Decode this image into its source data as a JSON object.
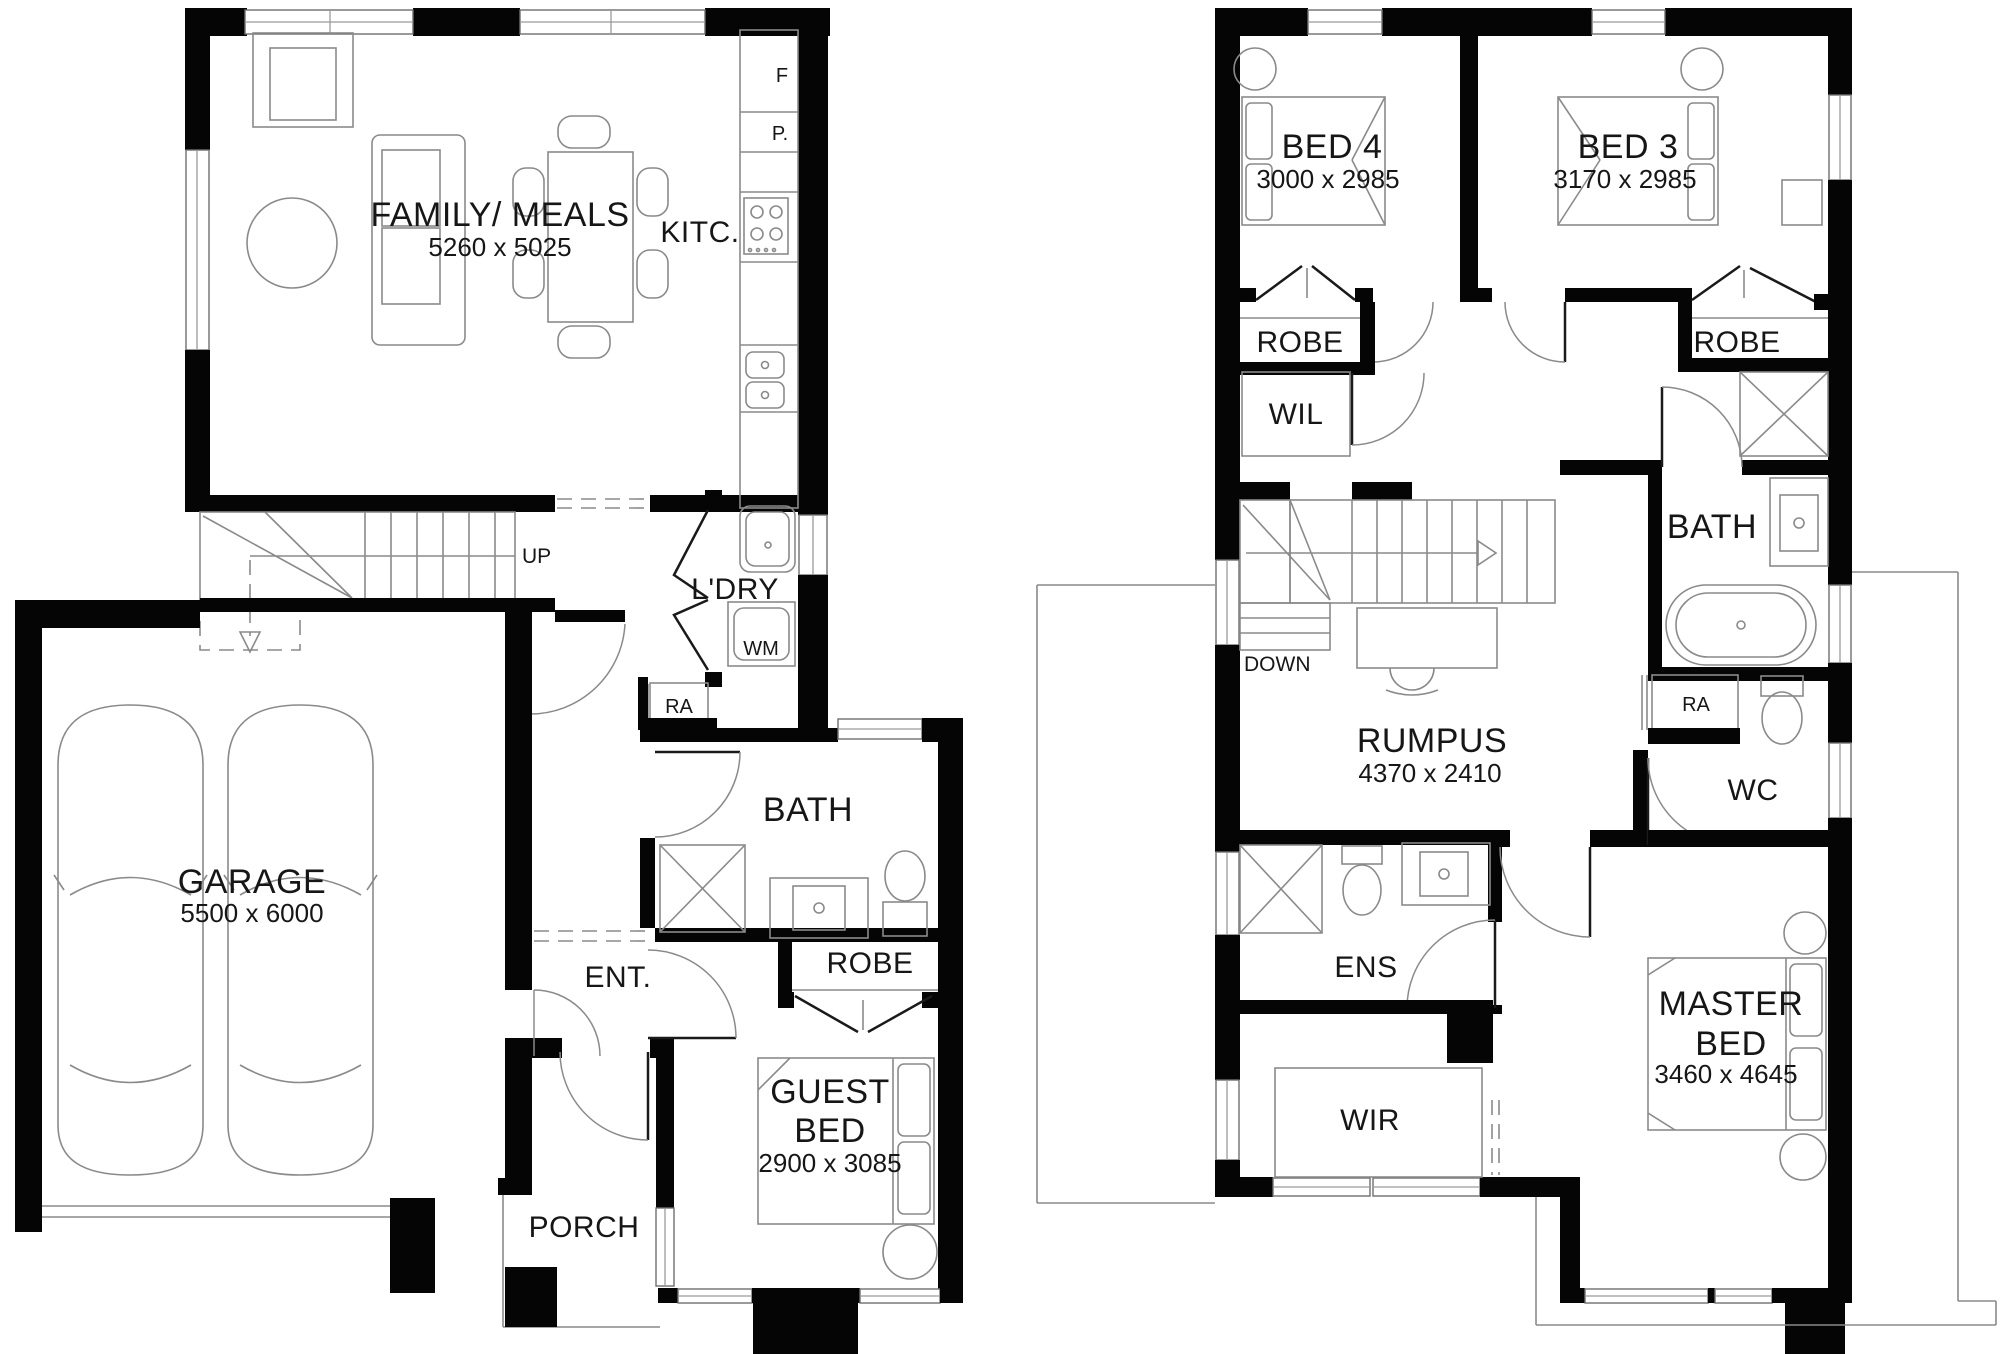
{
  "colors": {
    "wall": "#000000",
    "line": "#8a8a8a",
    "text": "#161616",
    "background": "#ffffff"
  },
  "ground_floor": {
    "family_meals": {
      "label": "FAMILY/ MEALS",
      "dims": "5260 x 5025"
    },
    "kitchen": {
      "label": "KITC.",
      "fridge": "F",
      "pantry": "P."
    },
    "stairs": {
      "label": "UP"
    },
    "laundry": {
      "label": "L'DRY",
      "washing_machine": "WM"
    },
    "return_air": {
      "label": "RA"
    },
    "bath": {
      "label": "BATH"
    },
    "robe": {
      "label": "ROBE"
    },
    "guest_bed": {
      "line1": "GUEST",
      "line2": "BED",
      "dims": "2900 x 3085"
    },
    "garage": {
      "label": "GARAGE",
      "dims": "5500 x 6000"
    },
    "entry": {
      "label": "ENT."
    },
    "porch": {
      "label": "PORCH"
    }
  },
  "first_floor": {
    "bed4": {
      "label": "BED 4",
      "dims": "3000 x 2985",
      "robe": "ROBE"
    },
    "bed3": {
      "label": "BED 3",
      "dims": "3170 x 2985",
      "robe": "ROBE"
    },
    "walk_in_linen": {
      "label": "WIL"
    },
    "bath": {
      "label": "BATH"
    },
    "stairs": {
      "label": "DOWN"
    },
    "rumpus": {
      "label": "RUMPUS",
      "dims": "4370 x 2410"
    },
    "return_air": {
      "label": "RA"
    },
    "wc": {
      "label": "WC"
    },
    "ensuite": {
      "label": "ENS"
    },
    "walk_in_robe": {
      "label": "WIR"
    },
    "master_bed": {
      "line1": "MASTER",
      "line2": "BED",
      "dims": "3460 x 4645"
    }
  }
}
